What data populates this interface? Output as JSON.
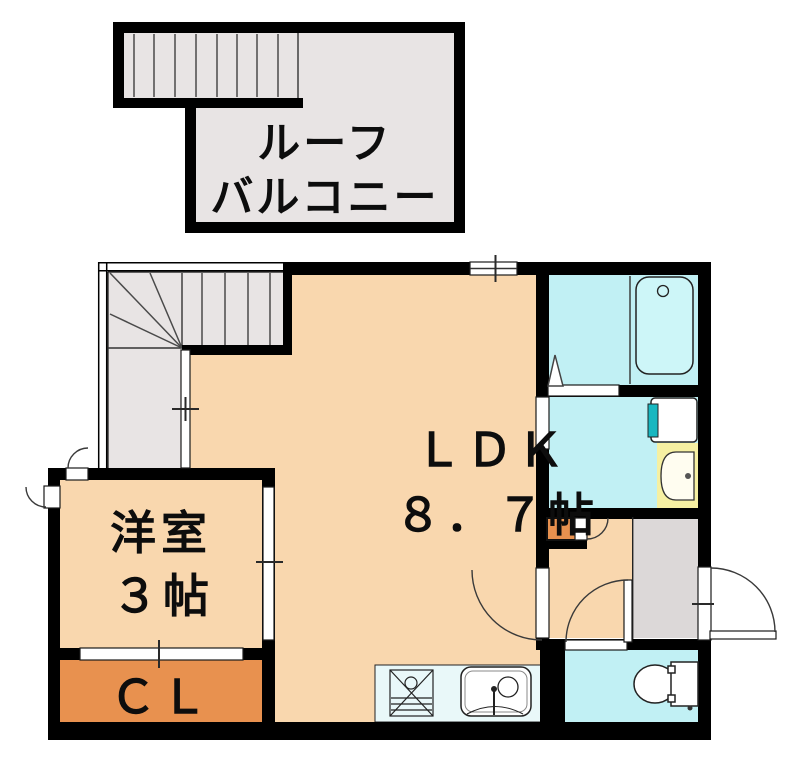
{
  "floorplan": {
    "roof_balcony": {
      "label_line1": "ルーフ",
      "label_line2": "バルコニー"
    },
    "rooms": {
      "ldk": {
        "name": "ＬＤＫ",
        "size": "８．７帖"
      },
      "western_room": {
        "name": "洋室",
        "size": "３帖"
      },
      "closet": {
        "name": "ＣＬ"
      }
    },
    "fixtures": [
      "staircase-icon",
      "bathtub-icon",
      "wash-basin-icon",
      "washing-machine-icon",
      "toilet-icon",
      "kitchen-sink-icon",
      "gas-stove-icon",
      "entrance-door-icon"
    ],
    "colors": {
      "wall": "#000000",
      "room_peach": "#f9d7ae",
      "stair_gray": "#e8e4e4",
      "entrance_gray": "#dcd8d8",
      "wet_area_cyan": "#c1f0f4",
      "bathtub_cyan": "#cdf6f8",
      "kitchen_counter": "#e9f8f9",
      "closet_orange": "#e8914f",
      "basin_yellow": "#f6f0a2",
      "washer_teal": "#18b7c0"
    }
  }
}
